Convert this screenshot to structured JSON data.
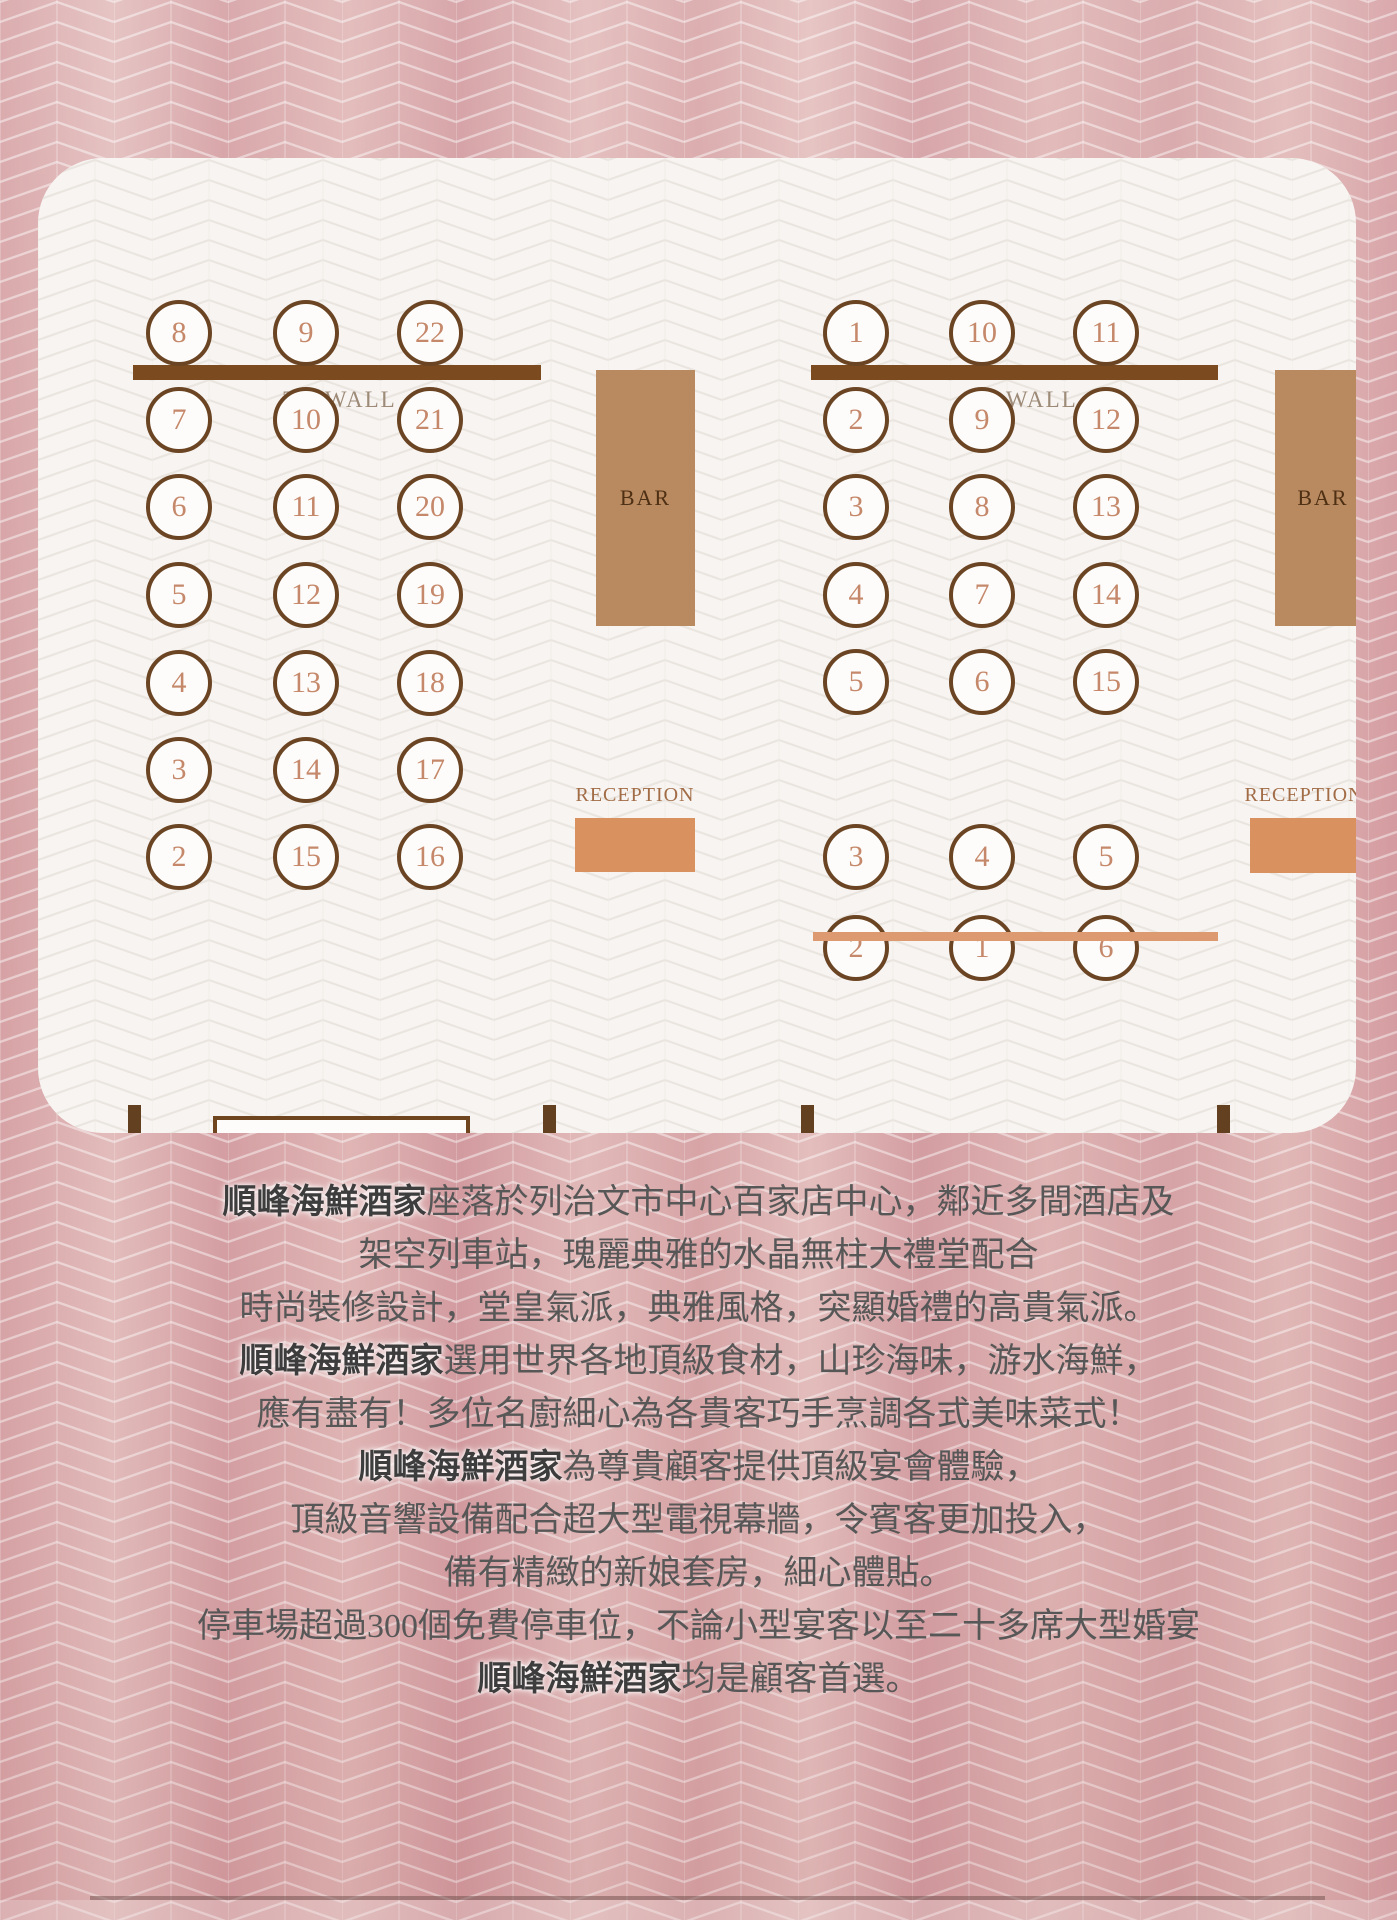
{
  "plans": {
    "left": {
      "tv_wall": "TV WALL",
      "bar": "BAR",
      "reception": "RECEPTION",
      "head_table": "HEAD TABLE",
      "tv_left": "TV",
      "tv_right": "TV",
      "window": "WINDOW (No.3 ROAD)",
      "columns": [
        [
          "8",
          "7",
          "6",
          "5",
          "4",
          "3",
          "2"
        ],
        [
          "9",
          "10",
          "11",
          "12",
          "13",
          "14",
          "15"
        ],
        [
          "22",
          "21",
          "20",
          "19",
          "18",
          "17",
          "16"
        ]
      ]
    },
    "right": {
      "tv_wall": "TV WALL",
      "bar": "BAR",
      "reception": "RECEPTION",
      "tv_left": "TV",
      "tv_right": "TV",
      "window": "WINDOW (No.3 ROAD)",
      "upper_columns": [
        [
          "1",
          "2",
          "3",
          "4",
          "5"
        ],
        [
          "10",
          "9",
          "8",
          "7",
          "6"
        ],
        [
          "11",
          "12",
          "13",
          "14",
          "15"
        ]
      ],
      "lower_rows": [
        [
          "3",
          "4",
          "5"
        ],
        [
          "2",
          "1",
          "6"
        ]
      ]
    }
  },
  "description": {
    "lines": [
      {
        "segments": [
          {
            "text": "順峰海鮮酒家",
            "bold": true
          },
          {
            "text": "座落於列治文市中心百家店中心，鄰近多間酒店及",
            "bold": false
          }
        ]
      },
      {
        "segments": [
          {
            "text": "架空列車站，瑰麗典雅的水晶無柱大禮堂配合",
            "bold": false
          }
        ]
      },
      {
        "segments": [
          {
            "text": "時尚裝修設計，堂皇氣派，典雅風格，突顯婚禮的高貴氣派。",
            "bold": false
          }
        ]
      },
      {
        "segments": [
          {
            "text": "順峰海鮮酒家",
            "bold": true
          },
          {
            "text": "選用世界各地頂級食材，山珍海味，游水海鮮，",
            "bold": false
          }
        ]
      },
      {
        "segments": [
          {
            "text": "應有盡有！多位名廚細心為各貴客巧手烹調各式美味菜式！",
            "bold": false
          }
        ]
      },
      {
        "segments": [
          {
            "text": "順峰海鮮酒家",
            "bold": true
          },
          {
            "text": "為尊貴顧客提供頂級宴會體驗，",
            "bold": false
          }
        ]
      },
      {
        "segments": [
          {
            "text": "頂級音響設備配合超大型電視幕牆，令賓客更加投入，",
            "bold": false
          }
        ]
      },
      {
        "segments": [
          {
            "text": "備有精緻的新娘套房，細心體貼。",
            "bold": false
          }
        ]
      },
      {
        "segments": [
          {
            "text": "停車場超過300個免費停車位，不論小型宴客以至二十多席大型婚宴",
            "bold": false
          }
        ]
      },
      {
        "segments": [
          {
            "text": "順峰海鮮酒家",
            "bold": true
          },
          {
            "text": "均是顧客首選。",
            "bold": false
          }
        ]
      }
    ]
  },
  "colors": {
    "background_pink": "#d9a7a9",
    "panel": "#f7f4f2",
    "wall_brown": "#7b4a1e",
    "circle_border": "#6b4523",
    "table_number": "#c5886a",
    "bar_fill": "#b9895f",
    "reception_fill": "#d9925f",
    "divider": "#dd9a70",
    "window_line": "#4cc7cd",
    "window_text": "#3bb5c1",
    "tv_post": "#63401f",
    "body_text": "#575757"
  }
}
